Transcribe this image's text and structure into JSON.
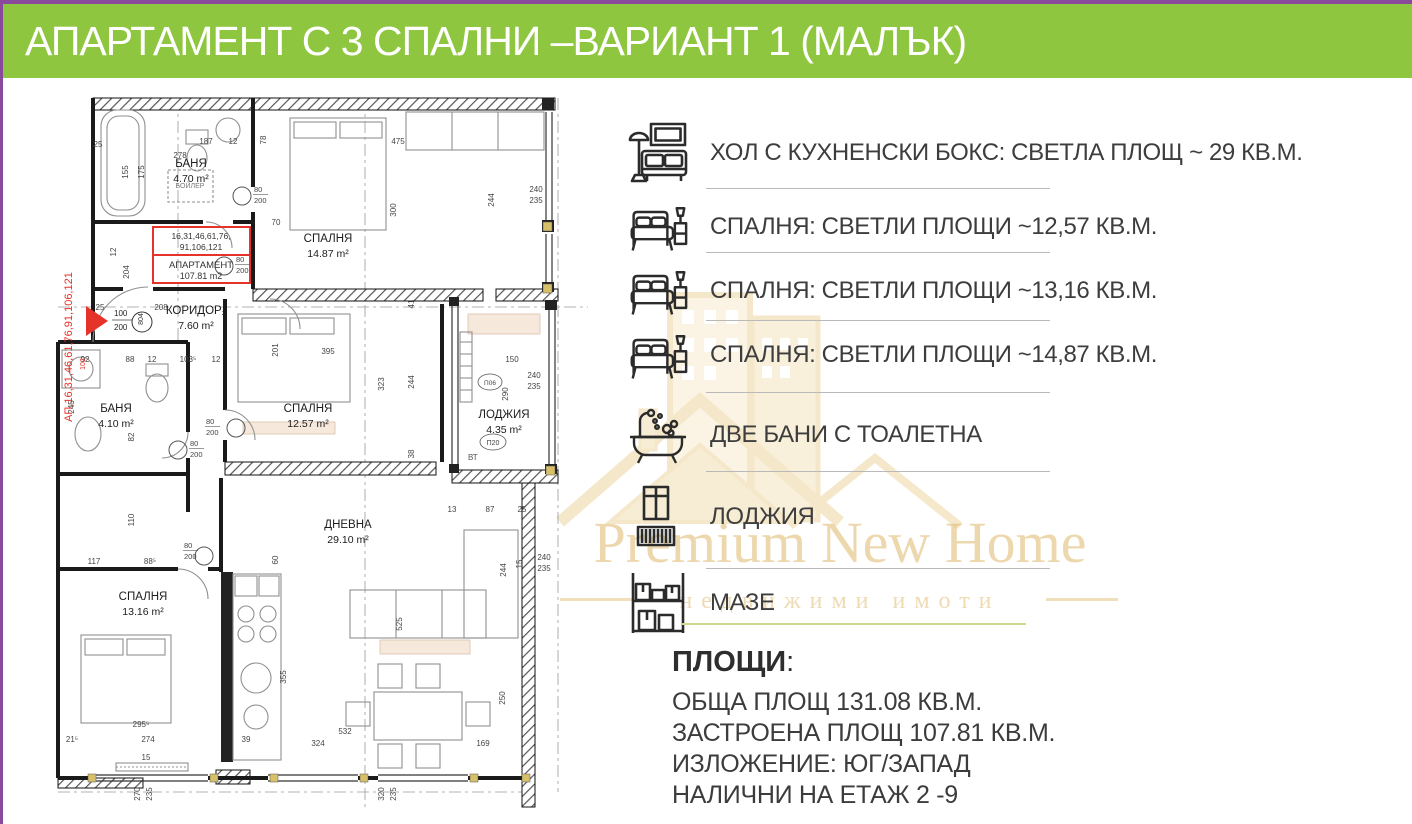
{
  "header": {
    "title": "АПАРТАМЕНТ С 3 СПАЛНИ –ВАРИАНТ 1 (МАЛЪК)"
  },
  "colors": {
    "banner_green": "#8ec63f",
    "accent_purple": "#8a4a9b",
    "watermark_gold": "#dfb86a",
    "red_annotation": "#e63329",
    "olive_separator": "#cfd98f"
  },
  "features": [
    {
      "icon": "sofa-icon",
      "label": "ХОЛ С КУХНЕНСКИ БОКС: СВЕТЛА ПЛОЩ ~ 29 КВ.М."
    },
    {
      "icon": "bed-icon",
      "label": "СПАЛНЯ: СВЕТЛИ ПЛОЩИ  ~12,57 КВ.М."
    },
    {
      "icon": "bed-icon",
      "label": "СПАЛНЯ: СВЕТЛИ ПЛОЩИ  ~13,16 КВ.М."
    },
    {
      "icon": "bed-icon",
      "label": "СПАЛНЯ: СВЕТЛИ ПЛОЩИ  ~14,87 КВ.М."
    },
    {
      "icon": "bathtub-icon",
      "label": "ДВЕ БАНИ С ТОАЛЕТНА"
    },
    {
      "icon": "loggia-icon",
      "label": "ЛОДЖИЯ"
    },
    {
      "icon": "storage-shelf-icon",
      "label": "МАЗЕ"
    }
  ],
  "areas": {
    "heading": "ПЛОЩИ",
    "heading_colon": ":",
    "lines": [
      "ОБЩА ПЛОЩ  131.08 КВ.М.",
      "ЗАСТРОЕНА ПЛОЩ 107.81 КВ.М.",
      "ИЗЛОЖЕНИЕ: ЮГ/ЗАПАД",
      "НАЛИЧНИ НА  ЕТАЖ 2 -9"
    ]
  },
  "watermark": {
    "line1": "Premium New Home",
    "line2": "недвижими имоти"
  },
  "floorplan": {
    "rooms": [
      {
        "name": "БАНЯ",
        "area": "4.70 m²",
        "x": 163,
        "y": 75
      },
      {
        "name": "СПАЛНЯ",
        "area": "14.87 m²",
        "x": 300,
        "y": 150
      },
      {
        "name": "КОРИДОР₂",
        "area": "7.60 m²",
        "x": 168,
        "y": 222
      },
      {
        "name": "БАНЯ",
        "area": "4.10 m²",
        "x": 88,
        "y": 320
      },
      {
        "name": "СПАЛНЯ",
        "area": "12.57 m²",
        "x": 280,
        "y": 320
      },
      {
        "name": "ЛОДЖИЯ",
        "area": "4.35 m²",
        "x": 476,
        "y": 326
      },
      {
        "name": "СПАЛНЯ",
        "area": "13.16 m²",
        "x": 115,
        "y": 508
      },
      {
        "name": "ДНЕВНА",
        "area": "29.10 m²",
        "x": 320,
        "y": 436
      }
    ],
    "red": {
      "side_text": "АП,16,31,46,61,76,91,106,121",
      "box_line1": "16,31,46,61,76,",
      "box_line2": "91,106,121",
      "box_line3": "АПАРТАМЕНТ",
      "box_line4": "107.81 m2",
      "small": "102"
    },
    "entry": {
      "w": "100",
      "h": "200",
      "circle": "804"
    },
    "door_w": "80",
    "door_h": "200",
    "boiler": "БОЙЛЕР",
    "vt": "ВТ",
    "p06": "П06",
    "p20": "П20",
    "doors": [
      {
        "cx": 214,
        "cy": 104,
        "tx": 226,
        "ty": 100
      },
      {
        "cx": 196,
        "cy": 174,
        "tx": 208,
        "ty": 170
      },
      {
        "cx": 150,
        "cy": 358,
        "tx": 162,
        "ty": 354
      },
      {
        "cx": 208,
        "cy": 336,
        "tx": 178,
        "ty": 332
      },
      {
        "cx": 176,
        "cy": 464,
        "tx": 156,
        "ty": 456
      }
    ],
    "dims": [
      {
        "t": "25",
        "x": 70,
        "y": 55
      },
      {
        "t": "155",
        "x": 100,
        "y": 80,
        "r": 1
      },
      {
        "t": "175",
        "x": 116,
        "y": 80,
        "r": 1
      },
      {
        "t": "278",
        "x": 152,
        "y": 66
      },
      {
        "t": "187",
        "x": 178,
        "y": 52
      },
      {
        "t": "12",
        "x": 205,
        "y": 52
      },
      {
        "t": "475",
        "x": 370,
        "y": 52
      },
      {
        "t": "300",
        "x": 368,
        "y": 118,
        "r": 1
      },
      {
        "t": "78",
        "x": 238,
        "y": 48,
        "r": 1
      },
      {
        "t": "244",
        "x": 466,
        "y": 108,
        "r": 1
      },
      {
        "t": "240",
        "x": 508,
        "y": 100
      },
      {
        "t": "235",
        "x": 508,
        "y": 111
      },
      {
        "t": "41",
        "x": 386,
        "y": 212,
        "r": 1
      },
      {
        "t": "70",
        "x": 248,
        "y": 133
      },
      {
        "t": "204",
        "x": 101,
        "y": 180,
        "r": 1
      },
      {
        "t": "12",
        "x": 88,
        "y": 160,
        "r": 1
      },
      {
        "t": "25",
        "x": 72,
        "y": 218
      },
      {
        "t": "208",
        "x": 133,
        "y": 218
      },
      {
        "t": "201",
        "x": 250,
        "y": 258,
        "r": 1
      },
      {
        "t": "92",
        "x": 57,
        "y": 270
      },
      {
        "t": "88",
        "x": 102,
        "y": 270
      },
      {
        "t": "12",
        "x": 124,
        "y": 270
      },
      {
        "t": "103⁵",
        "x": 160,
        "y": 270
      },
      {
        "t": "12",
        "x": 188,
        "y": 270
      },
      {
        "t": "245",
        "x": 46,
        "y": 315,
        "r": 1
      },
      {
        "t": "82",
        "x": 106,
        "y": 345,
        "r": 1
      },
      {
        "t": "395",
        "x": 300,
        "y": 262
      },
      {
        "t": "323",
        "x": 356,
        "y": 292,
        "r": 1
      },
      {
        "t": "244",
        "x": 386,
        "y": 290,
        "r": 1
      },
      {
        "t": "38",
        "x": 386,
        "y": 362,
        "r": 1
      },
      {
        "t": "150",
        "x": 484,
        "y": 270
      },
      {
        "t": "290",
        "x": 480,
        "y": 302,
        "r": 1
      },
      {
        "t": "240",
        "x": 506,
        "y": 286
      },
      {
        "t": "235",
        "x": 506,
        "y": 297
      },
      {
        "t": "110",
        "x": 106,
        "y": 428,
        "r": 1
      },
      {
        "t": "117",
        "x": 66,
        "y": 472
      },
      {
        "t": "88⁵",
        "x": 122,
        "y": 472
      },
      {
        "t": "60",
        "x": 250,
        "y": 468,
        "r": 1
      },
      {
        "t": "355",
        "x": 258,
        "y": 585,
        "r": 1
      },
      {
        "t": "295⁵",
        "x": 113,
        "y": 635
      },
      {
        "t": "274",
        "x": 120,
        "y": 650
      },
      {
        "t": "21⁵",
        "x": 44,
        "y": 650
      },
      {
        "t": "39",
        "x": 218,
        "y": 650
      },
      {
        "t": "15",
        "x": 118,
        "y": 668
      },
      {
        "t": "270",
        "x": 112,
        "y": 702,
        "r": 1
      },
      {
        "t": "235",
        "x": 124,
        "y": 702,
        "r": 1
      },
      {
        "t": "320",
        "x": 356,
        "y": 702,
        "r": 1
      },
      {
        "t": "235",
        "x": 368,
        "y": 702,
        "r": 1
      },
      {
        "t": "13",
        "x": 424,
        "y": 420
      },
      {
        "t": "87",
        "x": 462,
        "y": 420
      },
      {
        "t": "25",
        "x": 494,
        "y": 420
      },
      {
        "t": "244",
        "x": 478,
        "y": 478,
        "r": 1
      },
      {
        "t": "15",
        "x": 494,
        "y": 472,
        "r": 1
      },
      {
        "t": "240",
        "x": 516,
        "y": 468
      },
      {
        "t": "235",
        "x": 516,
        "y": 479
      },
      {
        "t": "250",
        "x": 477,
        "y": 606,
        "r": 1
      },
      {
        "t": "525",
        "x": 374,
        "y": 532,
        "r": 1
      },
      {
        "t": "532",
        "x": 317,
        "y": 642
      },
      {
        "t": "324",
        "x": 290,
        "y": 654
      },
      {
        "t": "169",
        "x": 455,
        "y": 654
      }
    ]
  }
}
